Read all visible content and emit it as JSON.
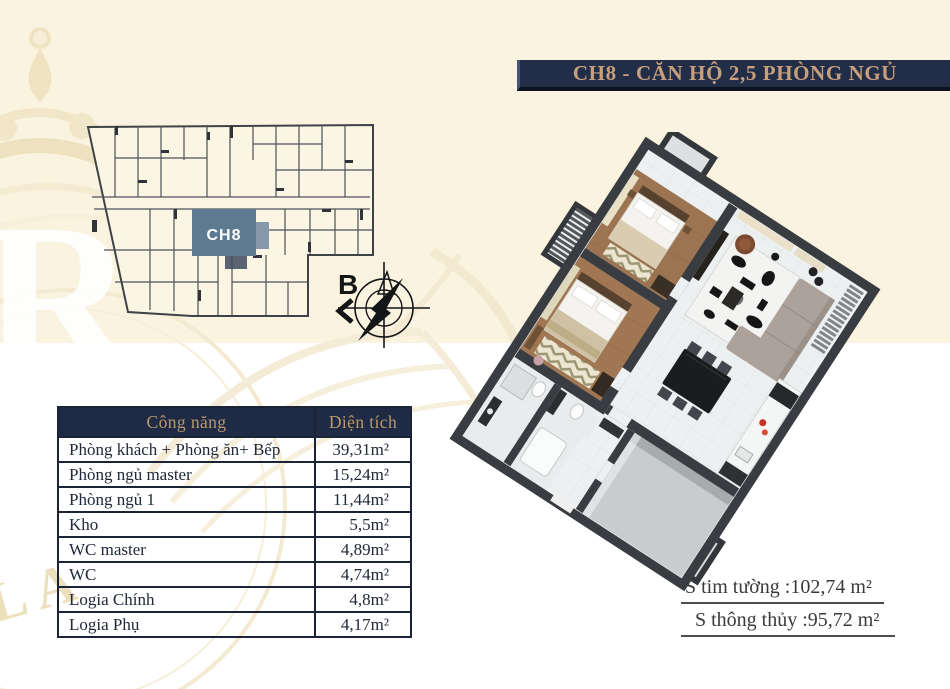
{
  "page": {
    "bg_top": "#faf3e0",
    "bg_bottom": "#ffffff"
  },
  "banner": {
    "title": "CH8 - CĂN HỘ 2,5 PHÒNG NGỦ",
    "bg": "#222d48",
    "fg": "#c79f7d"
  },
  "key_plan": {
    "unit_label": "CH8",
    "highlight_color": "#5e7a90"
  },
  "compass": {
    "north_label": "B"
  },
  "area_table": {
    "headers": [
      "Công năng",
      "Diện tích"
    ],
    "rows": [
      {
        "name": "Phòng khách + Phòng ăn+ Bếp",
        "area": "39,31m²"
      },
      {
        "name": "Phòng ngủ master",
        "area": "15,24m²"
      },
      {
        "name": "Phòng ngủ 1",
        "area": "11,44m²"
      },
      {
        "name": "Kho",
        "area": "5,5m²"
      },
      {
        "name": "WC master",
        "area": "4,89m²"
      },
      {
        "name": "WC",
        "area": "4,74m²"
      },
      {
        "name": "Logia Chính",
        "area": "4,8m²"
      },
      {
        "name": "Logia Phụ",
        "area": "4,17m²"
      }
    ]
  },
  "summary": {
    "gross_area": "S tim tường :102,74 m²",
    "net_area": "S thông thủy :95,72 m²"
  },
  "watermark": {
    "letter": "R",
    "letters_bottom": "LA"
  }
}
